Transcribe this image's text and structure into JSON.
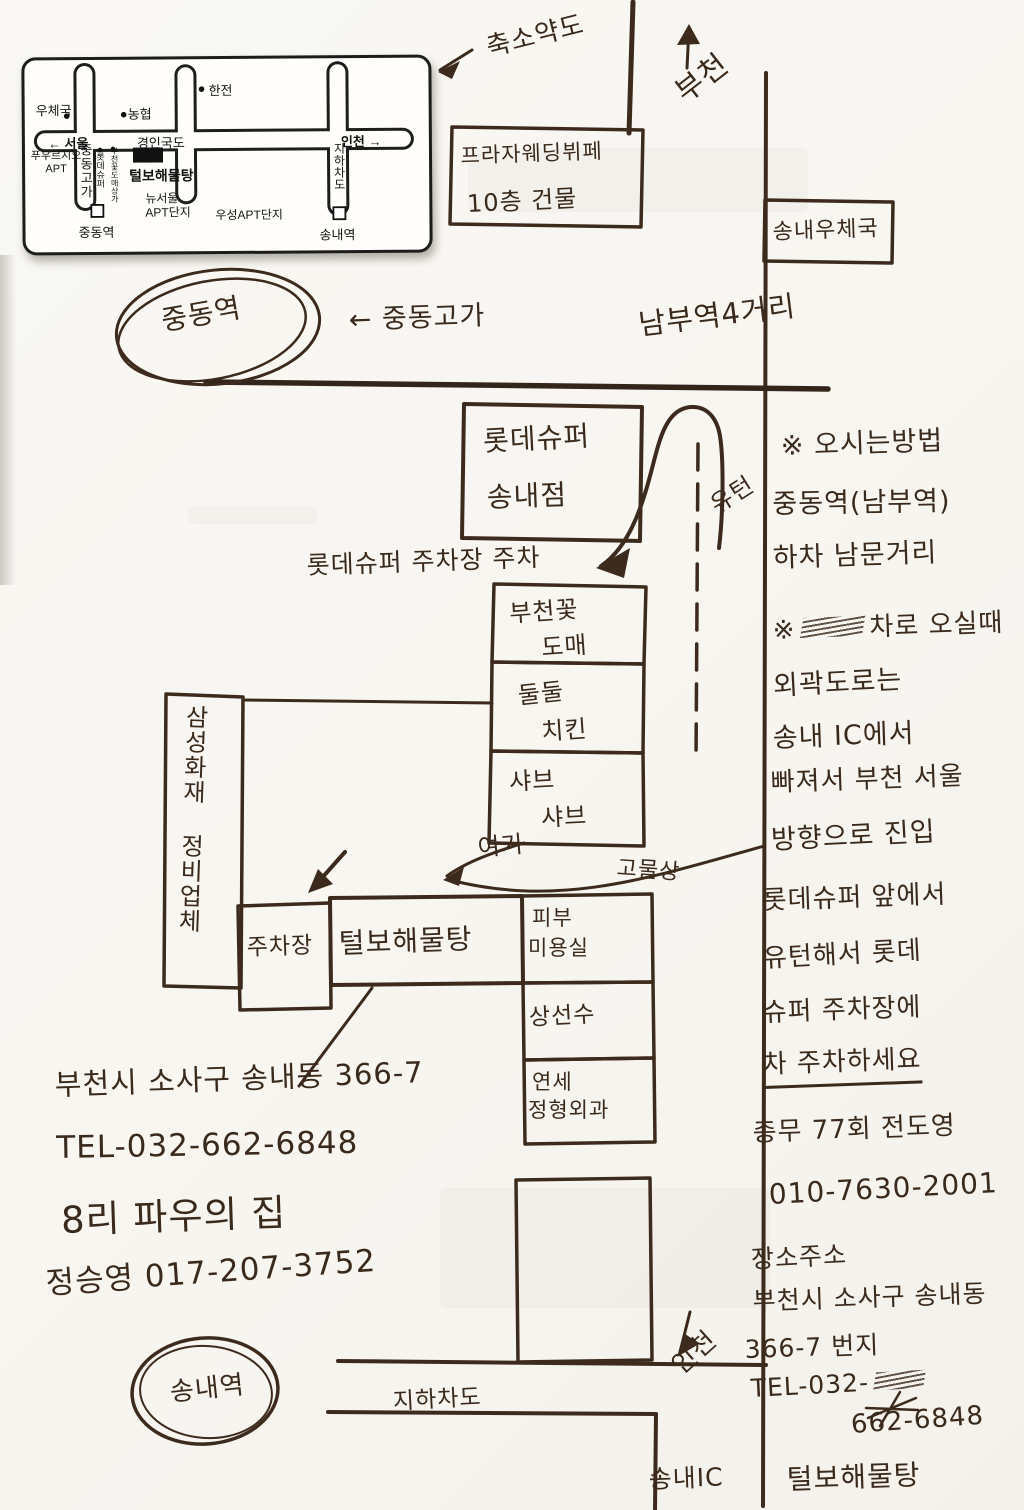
{
  "inset_map": {
    "labels": {
      "post_office": "우체국",
      "nonghyup": "농협",
      "hanjeon": "한전",
      "seoul_arrow": "← 서울",
      "gyeongin_road": "경인국도",
      "incheon_arrow": "인천 →",
      "prugio_line1": "푸우르지오",
      "prugio_line2": "APT",
      "jungdong_overpass": "중동고가",
      "lotte_super": "롯데슈퍼",
      "flower_market": "부천꽃도매상가",
      "talbo": "털보해물탕",
      "new_seoul_line1": "뉴서울",
      "new_seoul_line2": "APT단지",
      "woosung_apt": "우성APT단지",
      "underpass": "지하차도",
      "jungdong_station": "중동역",
      "songnae_station": "송내역"
    }
  },
  "sketch": {
    "reduced_map": "축소약도",
    "bucheon": "부천",
    "plaza_line1": "프라자웨딩뷔페",
    "plaza_line2": "10층 건물",
    "songnae_post": "송내우체국",
    "jungdong_station": "중동역",
    "jungdong_overpass": "← 중동고가",
    "nambu_crossing": "남부역4거리",
    "lotte_line1": "롯데슈퍼",
    "lotte_line2": "송내점",
    "uturn": "유턴",
    "parking_note": "롯데슈퍼 주차장 주차",
    "flower_line1": "부천꽃",
    "flower_line2": "도매",
    "chicken_line1": "둘둘",
    "chicken_line2": "치킨",
    "shabu_line1": "샤브",
    "shabu_line2": "샤브",
    "samsung_repair": "삼성화재 정비업체",
    "here": "여기",
    "junk_shop": "고물상",
    "parking_box": "주차장",
    "talbo": "털보해물탕",
    "skin_line1": "피부",
    "skin_line2": "미용실",
    "sangseonsu": "상선수",
    "yonsei_line1": "연세",
    "yonsei_line2": "정형외과",
    "songnae_station": "송내역",
    "underpass": "지하차도",
    "incheon": "인천",
    "songnae_ic": "송내IC"
  },
  "left_notes": {
    "address": "부천시 소사구 송내동 366-7",
    "tel": "TEL-032-662-6848",
    "line3": "8리 파우의 집",
    "line4": "정승영 017-207-3752"
  },
  "right_notes": {
    "heading": "※ 오시는방법",
    "line2": "중동역(남부역)",
    "line3": "하차 남문거리",
    "line4_prefix": "※",
    "line4": "차로 오실때",
    "line5": "외곽도로는",
    "line6": "송내 IC에서",
    "line7": "빠져서 부천 서울",
    "line8": "방향으로 진입",
    "line9": "롯데슈퍼 앞에서",
    "line10": "유턴해서 롯데",
    "line11": "슈퍼 주차장에",
    "line12": "차 주차하세요",
    "line13": "총무 77회 전도영",
    "line14": "010-7630-2001",
    "line15": "장소주소",
    "line16": "부천시 소사구 송내동",
    "line17": "366-7 번지",
    "line18": "TEL-032-",
    "line19": "662-6848",
    "line20": "털보해물탕"
  }
}
